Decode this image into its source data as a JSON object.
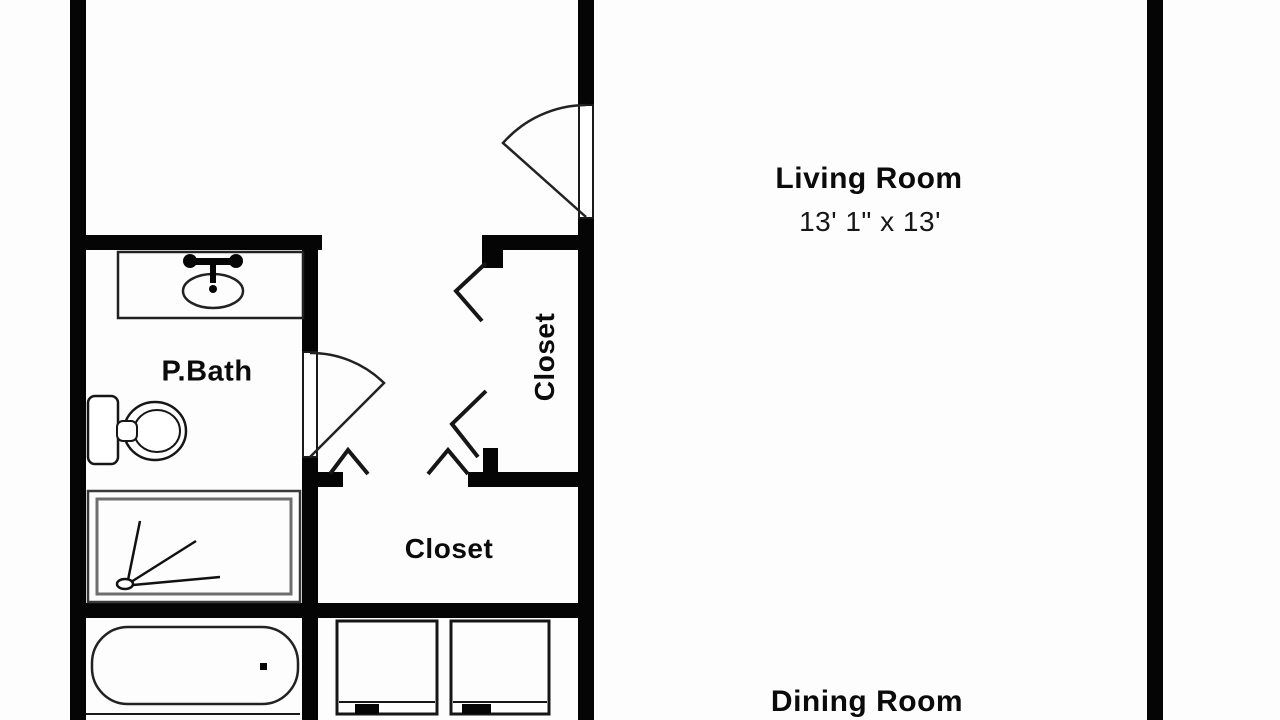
{
  "floor_plan": {
    "background_color": "#fdfdfd",
    "wall_color": "#050505",
    "line_color": "#1a1a1a",
    "rooms": {
      "living_room": {
        "label": "Living Room",
        "dimensions": "13' 1\" x 13'"
      },
      "dining_room": {
        "label": "Dining Room"
      },
      "primary_bath": {
        "label": "P.Bath"
      },
      "closet_side": {
        "label": "Closet"
      },
      "closet_lower": {
        "label": "Closet"
      }
    },
    "fixtures": [
      "vanity-sink",
      "toilet",
      "shower",
      "bathtub",
      "washer",
      "dryer",
      "entry-swing-door",
      "bath-swing-door",
      "bifold-closet-doors"
    ]
  }
}
